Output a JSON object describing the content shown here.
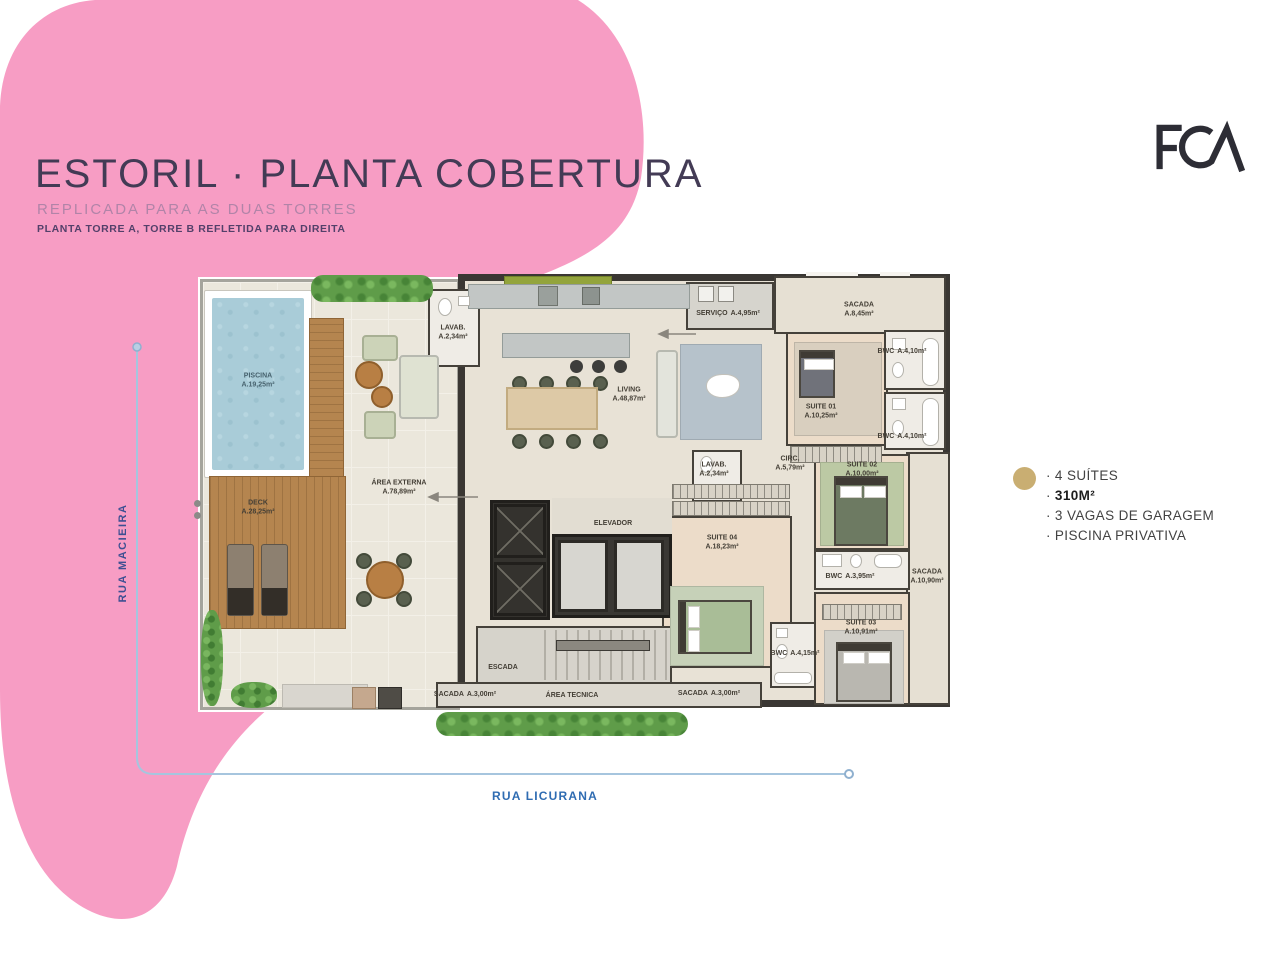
{
  "slide": {
    "title": "ESTORIL · PLANTA COBERTURA",
    "subtitle": "REPLICADA PARA AS DUAS TORRES",
    "note": "PLANTA TORRE A, TORRE B REFLETIDA PARA DIREITA",
    "logo": "FCA"
  },
  "streets": {
    "left": "RUA MACIEIRA",
    "bottom": "RUA LICURANA"
  },
  "features": {
    "bullet": "·",
    "items": [
      "4 SUÍTES",
      "310M²",
      "3 VAGAS DE GARAGEM",
      "PISCINA PRIVATIVA"
    ]
  },
  "colors": {
    "pink": "#f79dc4",
    "gold": "#c9ae72",
    "street_blue": "#2f6cb2",
    "wall": "#3a3733"
  },
  "plan": {
    "rooms": {
      "piscina": {
        "name": "PISCINA",
        "area": "A.19,25m²"
      },
      "deck": {
        "name": "DECK",
        "area": "A.28,25m²"
      },
      "area_externa": {
        "name": "ÁREA EXTERNA",
        "area": "A.78,89m²"
      },
      "lavab1": {
        "name": "LAVAB.",
        "area": "A.2,34m²"
      },
      "servico": {
        "name": "SERVIÇO",
        "area": "A.4,95m²"
      },
      "living": {
        "name": "LIVING",
        "area": "A.48,87m²"
      },
      "sacada1": {
        "name": "SACADA",
        "area": "A.8,45m²"
      },
      "bwc1": {
        "name": "BWC",
        "area": "A.4,10m²"
      },
      "suite01": {
        "name": "SUITE 01",
        "area": "A.10,25m²"
      },
      "bwc2": {
        "name": "BWC",
        "area": "A.4,10m²"
      },
      "circ": {
        "name": "CIRC.",
        "area": "A.5,79m²"
      },
      "lavab2": {
        "name": "LAVAB.",
        "area": "A.2,34m²"
      },
      "suite02": {
        "name": "SUITE 02",
        "area": "A.10,00m²"
      },
      "elevador": {
        "name": "ELEVADOR"
      },
      "suite04": {
        "name": "SUITE 04",
        "area": "A.18,23m²"
      },
      "bwc3": {
        "name": "BWC",
        "area": "A.3,95m²"
      },
      "sacada2": {
        "name": "SACADA",
        "area": "A.10,90m²"
      },
      "suite03": {
        "name": "SUITE 03",
        "area": "A.10,91m²"
      },
      "bwc4": {
        "name": "BWC",
        "area": "A.4,15m²"
      },
      "escada": {
        "name": "ESCADA"
      },
      "sacada3": {
        "name": "SACADA",
        "area": "A.3,00m²"
      },
      "area_tecnica": {
        "name": "ÁREA TECNICA"
      },
      "sacada4": {
        "name": "SACADA",
        "area": "A.3,00m²"
      }
    }
  }
}
